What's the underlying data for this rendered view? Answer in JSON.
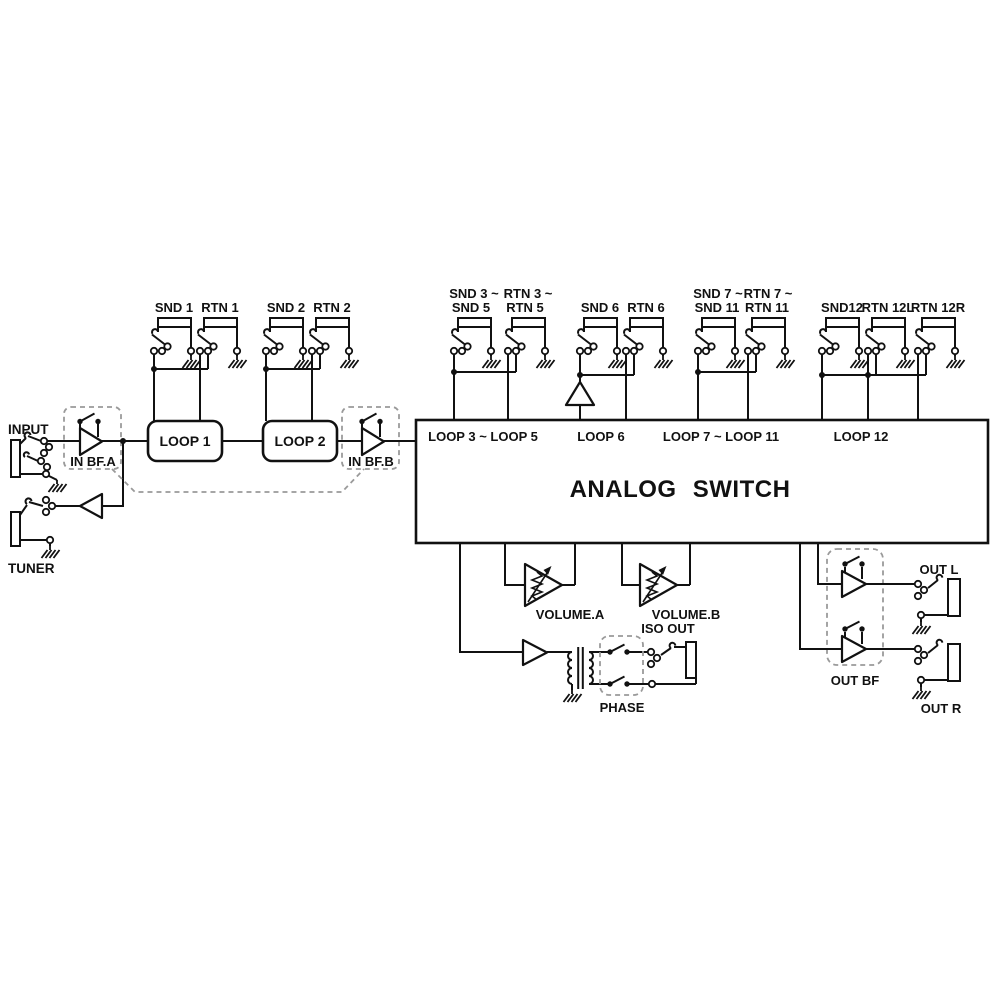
{
  "labels": {
    "input": "INPUT",
    "tuner": "TUNER",
    "in_bf_a": "IN BF.A",
    "in_bf_b": "IN BF.B",
    "loop1": "LOOP 1",
    "loop2": "LOOP 2",
    "snd1": "SND 1",
    "rtn1": "RTN 1",
    "snd2": "SND 2",
    "rtn2": "RTN 2",
    "snd3a": "SND 3 ~",
    "snd3b": "SND 5",
    "rtn3a": "RTN 3 ~",
    "rtn3b": "RTN 5",
    "snd6": "SND 6",
    "rtn6": "RTN 6",
    "snd7a": "SND 7 ~",
    "snd7b": "SND 11",
    "rtn7a": "RTN 7 ~",
    "rtn7b": "RTN 11",
    "snd12": "SND12",
    "rtn12l": "RTN 12L",
    "rtn12r": "RTN 12R",
    "as_loop3": "LOOP 3 ~ LOOP 5",
    "as_loop6": "LOOP 6",
    "as_loop7": "LOOP 7 ~ LOOP 11",
    "as_loop12": "LOOP 12",
    "analog_switch": "ANALOG SWITCH",
    "volume_a": "VOLUME.A",
    "volume_b": "VOLUME.B",
    "iso_out": "ISO OUT",
    "phase": "PHASE",
    "out_bf": "OUT BF",
    "out_l": "OUT L",
    "out_r": "OUT R"
  },
  "colors": {
    "line": "#111111",
    "dashed": "#9a9a9a",
    "background": "#ffffff"
  }
}
